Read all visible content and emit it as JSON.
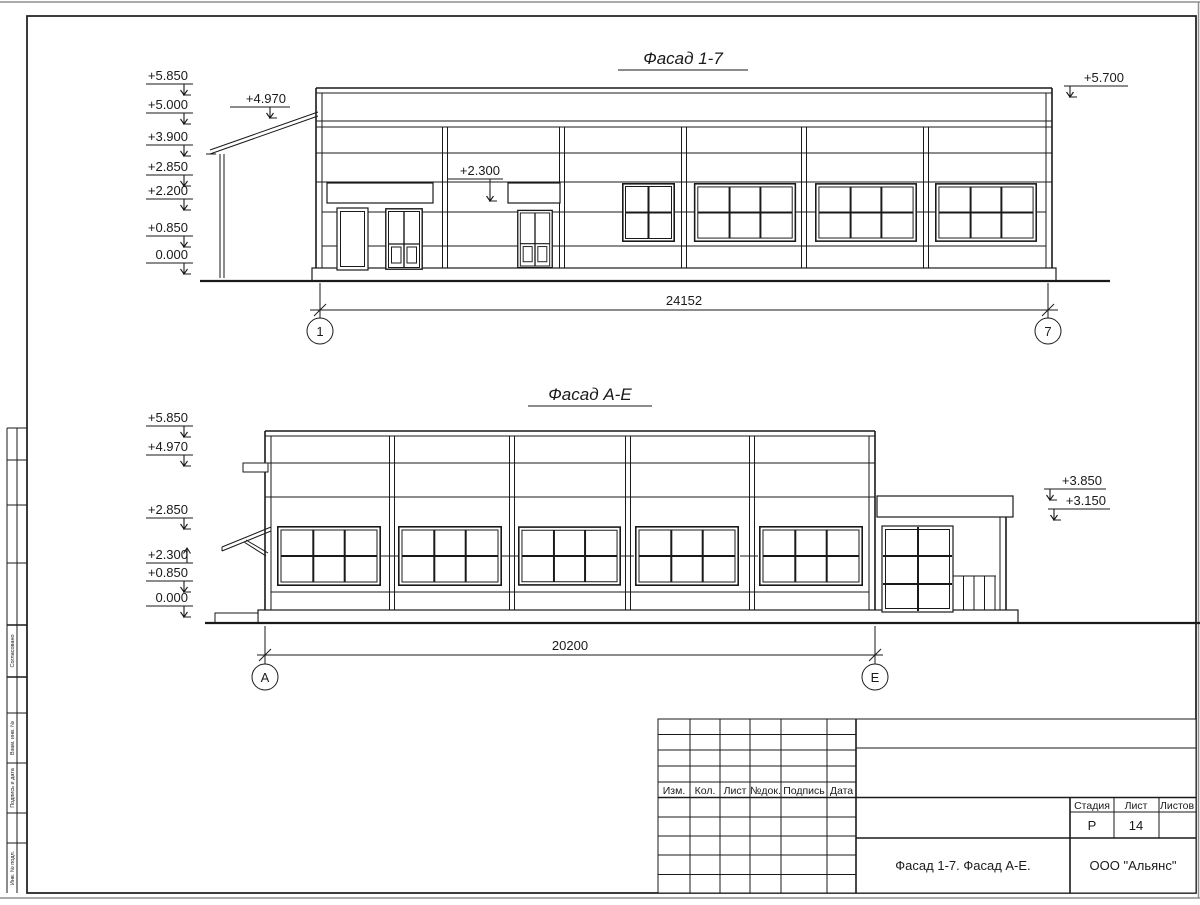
{
  "drawing": {
    "facade17": {
      "title": "Фасад 1-7",
      "levels": [
        "+5.850",
        "+5.000",
        "+3.900",
        "+2.850",
        "+2.200",
        "+0.850",
        "0.000"
      ],
      "canopy_level": "+4.970",
      "lintel_level": "+2.300",
      "parapet_level": "+5.700",
      "dimension": "24152",
      "axis_start": "1",
      "axis_end": "7"
    },
    "facadeAE": {
      "title": "Фасад А-Е",
      "levels": [
        "+5.850",
        "+4.970",
        "+2.850",
        "+2.300",
        "+0.850",
        "0.000"
      ],
      "annex_levels": [
        "+3.850",
        "+3.150"
      ],
      "dimension": "20200",
      "axis_start": "А",
      "axis_end": "Е"
    },
    "titleblock": {
      "rev_columns": [
        "Изм.",
        "Кол.",
        "Лист",
        "№док.",
        "Подпись",
        "Дата"
      ],
      "stage_label": "Стадия",
      "sheet_label": "Лист",
      "sheets_label": "Листов",
      "stage_value": "Р",
      "sheet_value": "14",
      "sheets_value": "",
      "doc_title": "Фасад 1-7. Фасад А-Е.",
      "company": "ООО \"Альянс\""
    },
    "margin_labels": [
      "Согласовано",
      "Взам. инв. №",
      "Подпись и дата",
      "Инв. № подл."
    ]
  }
}
